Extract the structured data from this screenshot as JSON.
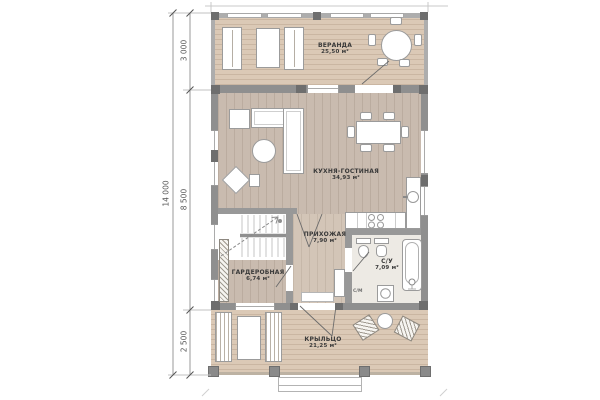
{
  "plan": {
    "rooms": [
      {
        "name": "ВЕРАНДА",
        "area": "25,50 м²"
      },
      {
        "name": "КУХНЯ-ГОСТИНАЯ",
        "area": "34,93 м²"
      },
      {
        "name": "ГАРДЕРОБНАЯ",
        "area": "6,74 м²"
      },
      {
        "name": "ПРИХОЖАЯ",
        "area": "7,90 м²"
      },
      {
        "name": "С/У",
        "area": "7,09 м²"
      },
      {
        "name": "КРЫЛЬЦО",
        "area": "21,25 м²"
      }
    ],
    "labels": {
      "washing_machine": "С/М"
    },
    "dimensions": {
      "overall_height": "14 000",
      "veranda_depth": "3 000",
      "house_depth": "8 500",
      "porch_depth": "2 500"
    },
    "colors": {
      "wall": "#8f8f8f",
      "deck": "#dbc9b6",
      "interior_wood": "#c9bbaf",
      "bathroom_floor": "#edeae4"
    }
  }
}
